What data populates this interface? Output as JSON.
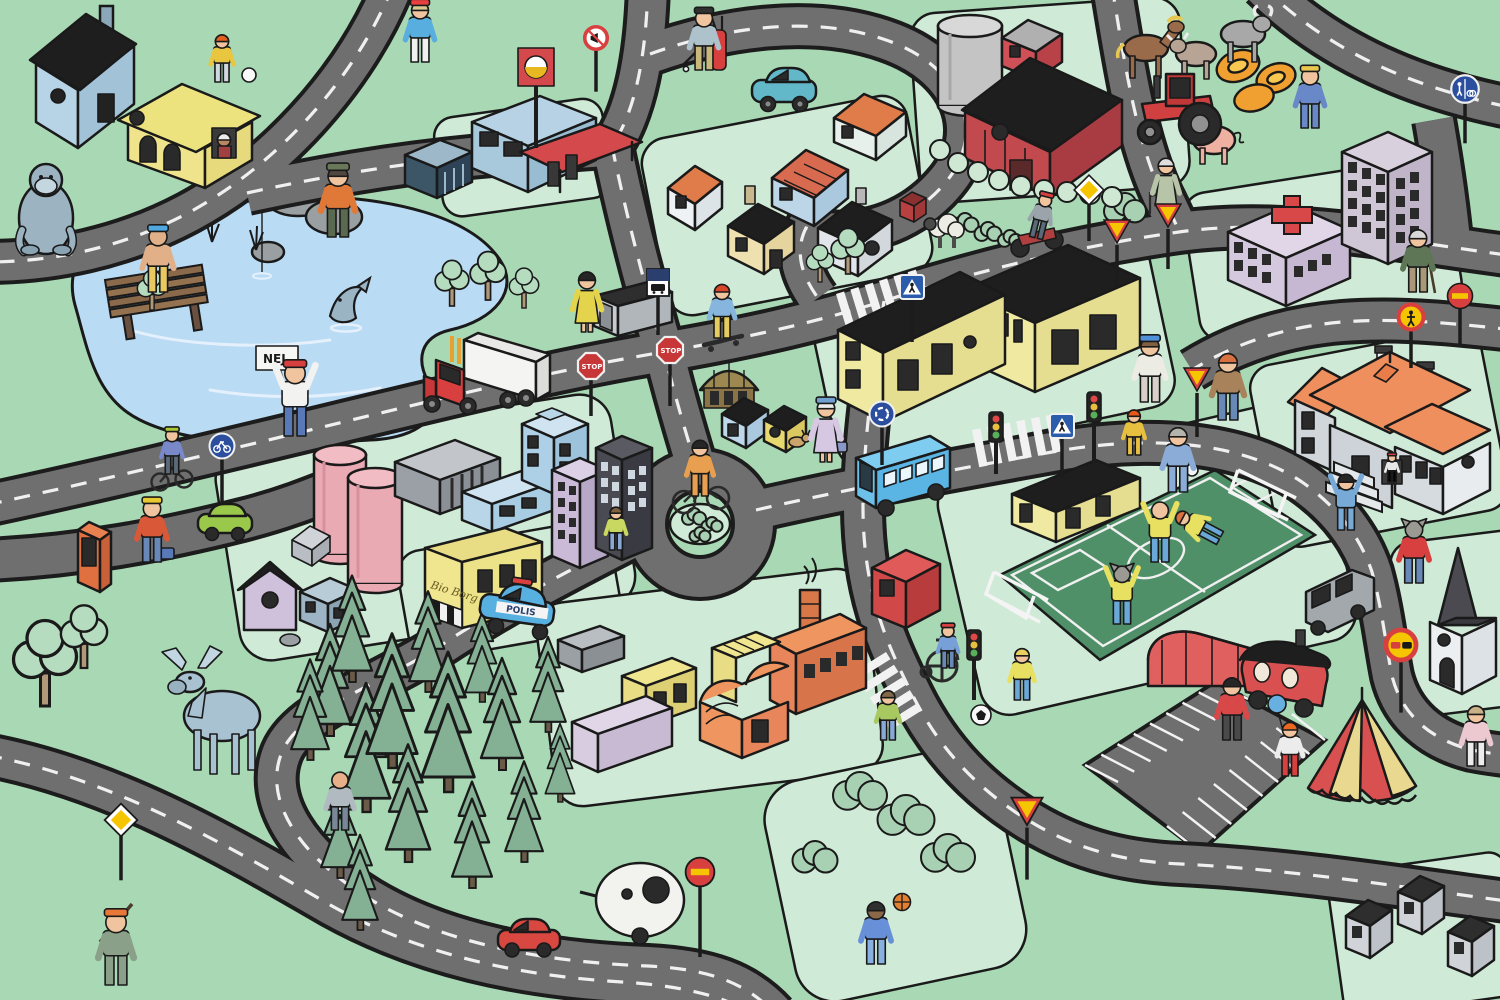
{
  "meta": {
    "title": "Illustrated children's town traffic play map",
    "style": "cartoon isometric illustration",
    "language": "Swedish"
  },
  "palette": {
    "grass": "#a8d8b4",
    "sidewalk": "#cfead6",
    "road": "#6f6f6f",
    "road_casing": "#1c1c1c",
    "road_line": "#f0f0f0",
    "water": "#badbf4",
    "pitch": "#4f9068",
    "pine": "#84b094",
    "sign_red": "#d84040",
    "sign_yellow": "#f5c500",
    "sign_blue": "#2b4f9e"
  },
  "texts": {
    "protest_sign": "NEJ",
    "stop_sign": "STOP",
    "police_car": "POLIS",
    "cinema_sign": "Bio Borg"
  },
  "roads": [
    {
      "d": "M 393,-14 C 352,85 272,168 188,213 C 122,248 52,262 -14,262",
      "dash": true
    },
    {
      "d": "M 247,193 C 352,170 452,156 548,151 C 578,149 598,148 612,146 C 636,110 646,55 648,-14",
      "dash": true
    },
    {
      "d": "M -14,505 C 140,472 300,432 452,396 C 542,375 602,362 664,352 C 762,335 822,320 884,301 C 982,269 1082,246 1172,233 C 1282,216 1392,240 1514,256",
      "dash": true
    },
    {
      "d": "M 650,54 C 722,28 812,14 886,40 C 962,66 988,132 946,182 C 906,230 846,240 806,228 C 794,252 802,276 818,298",
      "dash": true
    },
    {
      "d": "M 612,146 C 626,215 646,290 664,352 C 680,416 690,445 697,470",
      "dash": true
    },
    {
      "d": "M 756,510 C 852,488 952,470 1052,452 C 1152,434 1242,442 1302,482 C 1342,510 1362,542 1372,572 C 1382,608 1386,646 1392,676 C 1402,716 1432,740 1472,750 C 1492,754 1506,755 1514,756",
      "dash": true
    },
    {
      "d": "M 884,301 C 872,382 864,440 863,500 C 862,590 886,642 913,696 C 941,752 981,792 1031,822 C 1081,852 1131,862 1181,864 C 1301,870 1421,890 1514,902",
      "dash": true
    },
    {
      "d": "M 648,530 C 570,570 500,606 440,646 C 370,690 300,710 282,752 C 262,800 300,856 368,898 C 440,942 540,962 648,966 C 708,969 746,982 775,1014",
      "dash": true
    },
    {
      "d": "M -14,755 C 110,778 222,842 332,906 C 422,956 522,976 622,982 C 672,985 722,994 752,1014",
      "dash": true
    },
    {
      "d": "M -14,560 C 80,556 162,540 242,520 C 282,510 312,498 342,486",
      "dash": false
    },
    {
      "d": "M 1262,-14 C 1322,45 1402,86 1514,108",
      "dash": true
    },
    {
      "d": "M 1434,120 C 1442,165 1448,208 1452,250",
      "dash": false
    },
    {
      "d": "M 1514,330 C 1442,322 1392,318 1342,322 C 1282,327 1232,345 1192,370",
      "dash": true
    },
    {
      "d": "M 1112,-14 C 1124,60 1136,140 1162,195 C 1172,215 1176,225 1180,233",
      "dash": true
    }
  ],
  "roundabout": {
    "cx": 700,
    "cy": 524,
    "r": 54,
    "island_rx": 30,
    "island_ry": 20
  },
  "crosswalks": [
    {
      "x": 836,
      "y": 294,
      "r": -17,
      "n": 6
    },
    {
      "x": 972,
      "y": 430,
      "r": -11,
      "n": 6
    },
    {
      "x": 886,
      "y": 652,
      "r": 58,
      "n": 5
    }
  ],
  "parking": {
    "a": [
      1085,
      765
    ],
    "b": [
      1215,
      682
    ],
    "c": [
      1325,
      740
    ],
    "d": [
      1200,
      852
    ],
    "ticks": 8
  },
  "signs": [
    {
      "k": "yield",
      "x": 1168,
      "y": 216,
      "p": 40
    },
    {
      "k": "yield",
      "x": 1117,
      "y": 232,
      "p": 42
    },
    {
      "k": "yield",
      "x": 1197,
      "y": 380,
      "p": 44
    },
    {
      "k": "yield",
      "x": 1027,
      "y": 812,
      "p": 52,
      "s": 1.2
    },
    {
      "k": "diamond",
      "x": 1089,
      "y": 190,
      "p": 38
    },
    {
      "k": "diamond",
      "x": 121,
      "y": 820,
      "p": 46,
      "s": 1.1
    },
    {
      "k": "noentry",
      "x": 700,
      "y": 872,
      "p": 70,
      "s": 1.15
    },
    {
      "k": "noentry",
      "x": 1460,
      "y": 296,
      "p": 36
    },
    {
      "k": "noped",
      "x": 1411,
      "y": 317,
      "p": 38
    },
    {
      "k": "noovertake",
      "x": 1401,
      "y": 645,
      "p": 52,
      "s": 1.2
    },
    {
      "k": "nohonk",
      "x": 596,
      "y": 38,
      "p": 42,
      "s": 0.9
    },
    {
      "k": "crosswalk",
      "x": 912,
      "y": 287,
      "p": 42
    },
    {
      "k": "crosswalk",
      "x": 1062,
      "y": 426,
      "p": 40
    },
    {
      "k": "busstop",
      "x": 658,
      "y": 282,
      "p": 40
    },
    {
      "k": "bikepath",
      "x": 222,
      "y": 446,
      "p": 44
    },
    {
      "k": "sharedpath",
      "x": 1465,
      "y": 89,
      "p": 40,
      "s": 1.1
    },
    {
      "k": "roundabout",
      "x": 882,
      "y": 414,
      "p": 38
    }
  ],
  "characters": [
    {
      "n": "scuba-diver",
      "x": 158,
      "y": 292,
      "h": 60,
      "sk": "#e2b088",
      "top": "#e2b088",
      "bot": "#e8c860",
      "hat": "#50a8e0"
    },
    {
      "n": "fisherman",
      "x": 338,
      "y": 237,
      "h": 66,
      "top": "#e07838",
      "bot": "#5a6a50",
      "hat": "#687858",
      "hair": "#504840"
    },
    {
      "n": "girl-with-ball",
      "x": 222,
      "y": 82,
      "h": 44,
      "top": "#e8c640",
      "bot": "#d0d8e0",
      "hair": "#e06020"
    },
    {
      "n": "jogger",
      "x": 420,
      "y": 62,
      "h": 56,
      "top": "#58aede",
      "bot": "#f0f0ee",
      "hair": "#d8c890",
      "hat": "#e84040"
    },
    {
      "n": "golfer",
      "x": 704,
      "y": 70,
      "h": 56,
      "top": "#aec2cc",
      "bot": "#c8b87a",
      "hat": "#303030"
    },
    {
      "n": "woman-bus-stop",
      "x": 587,
      "y": 332,
      "h": 56,
      "dress": true,
      "top": "#e4d44c",
      "hair": "#262626"
    },
    {
      "n": "skateboarder",
      "x": 722,
      "y": 338,
      "h": 50,
      "top": "#86b6de",
      "bot": "#e6ce5e",
      "hair": "#d84828"
    },
    {
      "n": "protester",
      "x": 295,
      "y": 436,
      "h": 68,
      "top": "#f2f2f0",
      "bot": "#5878b8",
      "hat": "#d84040",
      "up": true
    },
    {
      "n": "cyclist",
      "x": 700,
      "y": 496,
      "h": 52,
      "top": "#e8a050",
      "bot": "#e8a050",
      "hair": "#262626"
    },
    {
      "n": "old-lady",
      "x": 826,
      "y": 462,
      "h": 58,
      "dress": true,
      "top": "#d6c8e2",
      "hair": "#ececec",
      "hat": "#70a0d0"
    },
    {
      "n": "kid-cyclist",
      "x": 172,
      "y": 474,
      "h": 42,
      "top": "#7888c8",
      "bot": "#5a6a7a",
      "hat": "#aac838"
    },
    {
      "n": "construction-worker",
      "x": 152,
      "y": 562,
      "h": 58,
      "top": "#d85838",
      "bot": "#6888b8",
      "hat": "#e8c830"
    },
    {
      "n": "kid-near-tower",
      "x": 616,
      "y": 550,
      "h": 40,
      "top": "#c8d860",
      "bot": "#88a8d8",
      "hair": "#806040"
    },
    {
      "n": "runner",
      "x": 1150,
      "y": 402,
      "h": 60,
      "top": "#ecece4",
      "bot": "#d8d0c8",
      "hat": "#5090d8",
      "hair": "#806040"
    },
    {
      "n": "redhead-kid",
      "x": 1134,
      "y": 455,
      "h": 42,
      "top": "#e8c040",
      "bot": "#e8c040",
      "hair": "#e85818"
    },
    {
      "n": "man-with-bag",
      "x": 1178,
      "y": 492,
      "h": 60,
      "top": "#8cacd8",
      "bot": "#8cacd8",
      "hair": "#b4b4ac"
    },
    {
      "n": "man-brown-jacket",
      "x": 1228,
      "y": 420,
      "h": 62,
      "top": "#a8825a",
      "bot": "#6888b8",
      "hair": "#d87040"
    },
    {
      "n": "player-celebrating",
      "x": 1160,
      "y": 562,
      "h": 56,
      "top": "#e8e060",
      "bot": "#6aa8d8",
      "up": true
    },
    {
      "n": "player-sliding",
      "x": 1220,
      "y": 538,
      "h": 46,
      "top": "#e8e060",
      "bot": "#6aa8d8",
      "hair": "#d87040",
      "rot": -62
    },
    {
      "n": "wolf-player",
      "x": 1122,
      "y": 624,
      "h": 54,
      "sk": "#9a9a92",
      "top": "#e8e060",
      "bot": "#6aa8d8",
      "ears": true,
      "up": true
    },
    {
      "n": "girl-chasing-ball",
      "x": 1022,
      "y": 700,
      "h": 48,
      "top": "#e8e060",
      "bot": "#6aa8d8",
      "hair": "#e8d060"
    },
    {
      "n": "tracksuit-player",
      "x": 1346,
      "y": 530,
      "h": 52,
      "top": "#78aad8",
      "bot": "#78aad8",
      "up": true,
      "hair": "#262626"
    },
    {
      "n": "wolf-walker",
      "x": 1414,
      "y": 583,
      "h": 58,
      "sk": "#9a9a92",
      "top": "#d84040",
      "bot": "#6888b8",
      "ears": true
    },
    {
      "n": "old-man-cane",
      "x": 1418,
      "y": 292,
      "h": 58,
      "top": "#5e7656",
      "bot": "#a89878",
      "hair": "#d8d8d8"
    },
    {
      "n": "farmer",
      "x": 1310,
      "y": 128,
      "h": 56,
      "top": "#6888c8",
      "bot": "#6888c8",
      "hat": "#e8c850"
    },
    {
      "n": "grandma-walker",
      "x": 1166,
      "y": 214,
      "h": 52,
      "dress": true,
      "top": "#b8c4a8",
      "hair": "#dedede"
    },
    {
      "n": "hunter",
      "x": 116,
      "y": 985,
      "h": 68,
      "top": "#8aa088",
      "bot": "#8aa088",
      "hat": "#e87838"
    },
    {
      "n": "orienteer",
      "x": 340,
      "y": 830,
      "h": 54,
      "top": "#b0bac0",
      "bot": "#788898",
      "sk": "#e8b088"
    },
    {
      "n": "wheelchair-boy",
      "x": 948,
      "y": 668,
      "h": 40,
      "top": "#78a0d8",
      "bot": "#6888b8",
      "hat": "#d84040"
    },
    {
      "n": "girl-at-crossing",
      "x": 888,
      "y": 740,
      "h": 46,
      "top": "#a8c860",
      "bot": "#88a8d8",
      "hair": "#806848"
    },
    {
      "n": "basketball-boy",
      "x": 876,
      "y": 964,
      "h": 58,
      "sk": "#8a6848",
      "top": "#6890d8",
      "bot": "#88b0e0",
      "hair": "#303030"
    },
    {
      "n": "clown",
      "x": 1290,
      "y": 776,
      "h": 50,
      "top": "#ececec",
      "bot": "#d84040",
      "hair": "#e86820"
    },
    {
      "n": "man-red-jacket",
      "x": 1232,
      "y": 740,
      "h": 58,
      "top": "#d84848",
      "bot": "#4a4a4a",
      "hair": "#262626"
    },
    {
      "n": "person-pink",
      "x": 1476,
      "y": 766,
      "h": 56,
      "top": "#ecc8d0",
      "bot": "#ececec",
      "hair": "#c8b088"
    },
    {
      "n": "motorcyclist",
      "x": 1036,
      "y": 238,
      "h": 42,
      "top": "#9aa4aa",
      "bot": "#5a6a7a",
      "hat": "#d84040",
      "rot": 14
    },
    {
      "n": "mansion-window-kid",
      "x": 1392,
      "y": 482,
      "h": 26,
      "top": "#e8e8e8",
      "hat": "#d84040"
    }
  ],
  "nature": {
    "pines": [
      [
        330,
        736,
        1.0
      ],
      [
        366,
        812,
        1.15
      ],
      [
        340,
        878,
        0.9
      ],
      [
        352,
        682,
        0.95
      ],
      [
        392,
        768,
        1.2
      ],
      [
        408,
        862,
        1.05
      ],
      [
        360,
        930,
        0.85
      ],
      [
        428,
        692,
        0.9
      ],
      [
        448,
        792,
        1.25
      ],
      [
        472,
        888,
        0.95
      ],
      [
        482,
        702,
        0.8
      ],
      [
        502,
        770,
        1.0
      ],
      [
        524,
        862,
        0.9
      ],
      [
        548,
        732,
        0.85
      ],
      [
        560,
        802,
        0.7
      ],
      [
        310,
        760,
        0.9
      ]
    ],
    "trees": [
      [
        45,
        706,
        1.5
      ],
      [
        84,
        668,
        1.1
      ],
      [
        452,
        306,
        0.8
      ],
      [
        488,
        300,
        0.85
      ],
      [
        524,
        308,
        0.7
      ],
      [
        152,
        310,
        0.7
      ],
      [
        820,
        282,
        0.65
      ],
      [
        848,
        274,
        0.8
      ]
    ],
    "bushes": [
      [
        694,
        516,
        0.8
      ],
      [
        712,
        524,
        0.7
      ],
      [
        700,
        534,
        0.7
      ],
      [
        860,
        790,
        1.8
      ],
      [
        906,
        814,
        1.9
      ],
      [
        948,
        852,
        1.8
      ],
      [
        815,
        856,
        1.5
      ],
      [
        1125,
        207,
        1.4
      ],
      [
        965,
        222,
        0.9
      ],
      [
        988,
        231,
        0.9
      ],
      [
        1010,
        238,
        0.8
      ]
    ],
    "hedge": [
      [
        940,
        150
      ],
      [
        958,
        163
      ],
      [
        978,
        172
      ],
      [
        999,
        180
      ],
      [
        1021,
        186
      ],
      [
        1044,
        190
      ],
      [
        1067,
        192
      ],
      [
        1090,
        194
      ],
      [
        1112,
        197
      ]
    ]
  },
  "inventory": {
    "buildings": [
      "blue house",
      "yellow villa",
      "gas station",
      "warehouse",
      "cottage cluster",
      "silo",
      "red shed",
      "red barn",
      "school complex",
      "round kiosk",
      "blue cottage",
      "dog house",
      "hospital with red cross",
      "office tower",
      "mansion with orange roof",
      "sports clubhouse",
      "red cube house",
      "pink storage tanks",
      "gray warehouse",
      "blue office",
      "purple tower",
      "dark tower",
      "purple shed",
      "brick shed",
      "phone kiosk",
      "cinema Bio Borg",
      "orange factory",
      "yellow containers",
      "lavender hall",
      "red arched hall",
      "circus caravan",
      "circus tent",
      "church",
      "bus shelter",
      "three small houses"
    ],
    "vehicles": [
      "red semi truck",
      "teal car",
      "green car",
      "red hatchback",
      "egg-shaped caravan",
      "police car POLIS",
      "blue bus",
      "gray van",
      "gray minivan",
      "red tractor",
      "motorcycle",
      "bicycles",
      "skateboard",
      "wheelchair"
    ],
    "animals": [
      "gorilla",
      "moose",
      "horse",
      "cow",
      "bull",
      "pig",
      "sheep",
      "dog",
      "fish",
      "wolf characters"
    ]
  }
}
